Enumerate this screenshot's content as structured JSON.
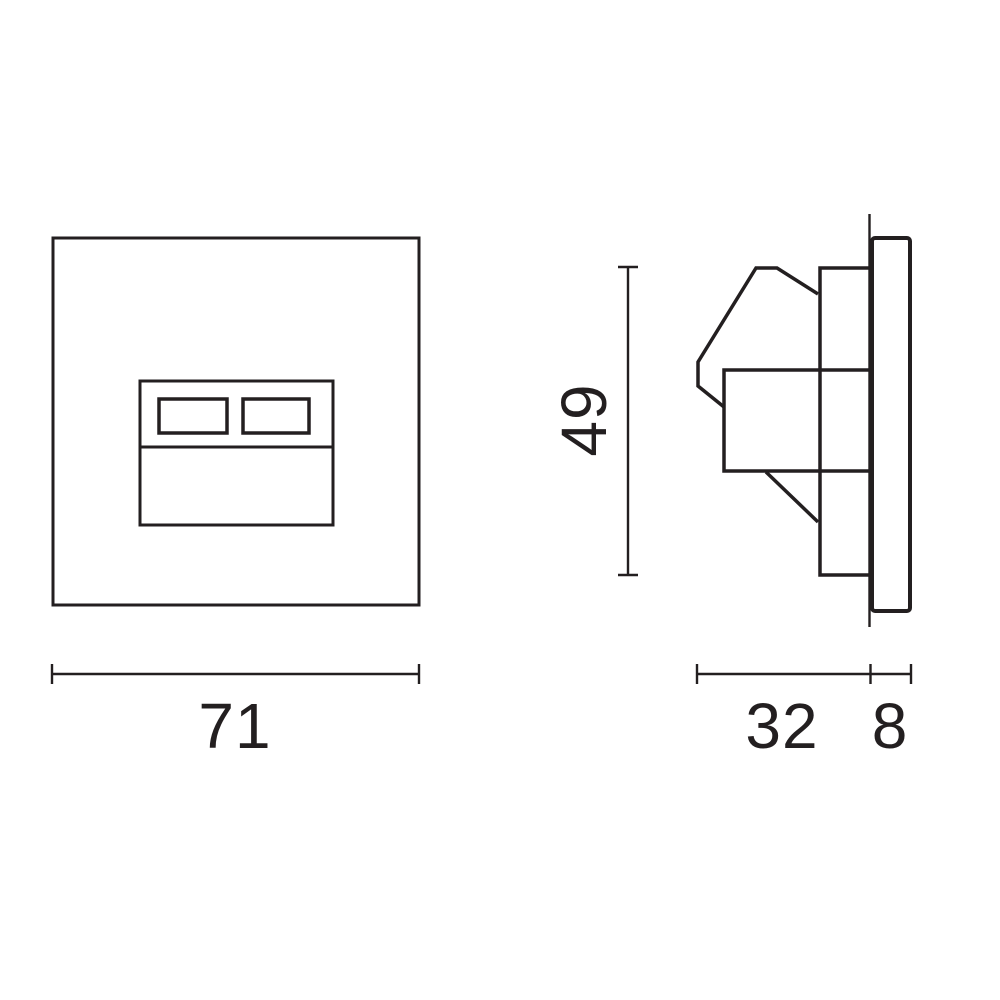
{
  "drawing": {
    "kind": "technical-dimension-drawing",
    "colors": {
      "line": "#231f20",
      "background": "#ffffff"
    },
    "dimensions": {
      "front_width": "71",
      "side_height": "49",
      "recess_depth": "32",
      "faceplate_thickness": "8"
    }
  }
}
